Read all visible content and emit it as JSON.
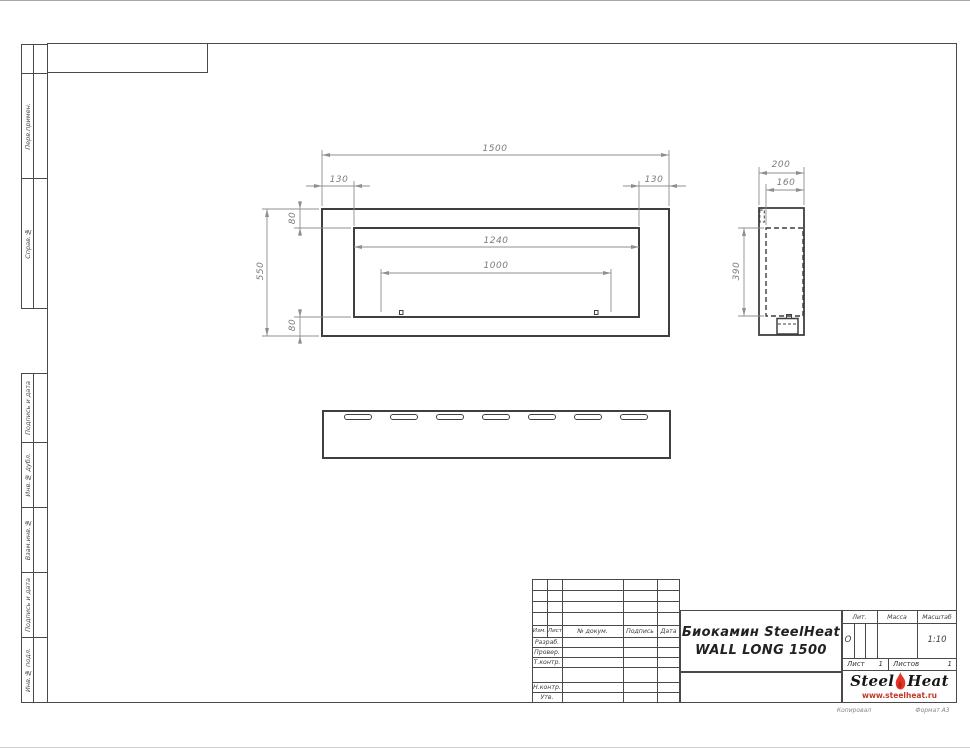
{
  "page": {
    "copied": "Копировал",
    "format": "Формат А3"
  },
  "margin_labels": {
    "perv": "Перв.примен.",
    "sprav": "Справ.№",
    "podpis1": "Подпись и дата",
    "inv_dubl": "Инв.№ дубл.",
    "vzam": "Взам.инв.№",
    "podpis2": "Подпись и дата",
    "inv_podl": "Инв.№ подл."
  },
  "dims": {
    "front_total_width": "1500",
    "front_left_offset": "130",
    "front_right_offset": "130",
    "front_top_offset": "80",
    "front_total_height": "550",
    "front_bottom_offset": "80",
    "front_opening_width": "1240",
    "front_burner_width": "1000",
    "side_depth": "200",
    "side_inner_depth": "160",
    "side_inner_height": "390"
  },
  "title_block": {
    "col_izm": "Изм.",
    "col_list": "Лист",
    "col_doc": "№ докум.",
    "col_sign": "Подпись",
    "col_date": "Дата",
    "row_developed": "Разраб.",
    "row_checked": "Провер.",
    "row_tcontrol": "Т.контр.",
    "row_ncontrol": "Н.контр.",
    "row_approved": "Утв.",
    "title_line1": "Биокамин SteelHeat",
    "title_line2": "WALL LONG 1500",
    "lit_label": "Лит.",
    "lit_value": "О",
    "mass_label": "Масса",
    "scale_label": "Масштаб",
    "scale_value": "1:10",
    "sheet_label": "Лист",
    "sheet_value": "1",
    "sheets_label": "Листов",
    "sheets_value": "1"
  },
  "logo": {
    "steel": "Steel",
    "heat": "Heat",
    "url": "www.steelheat.ru"
  }
}
